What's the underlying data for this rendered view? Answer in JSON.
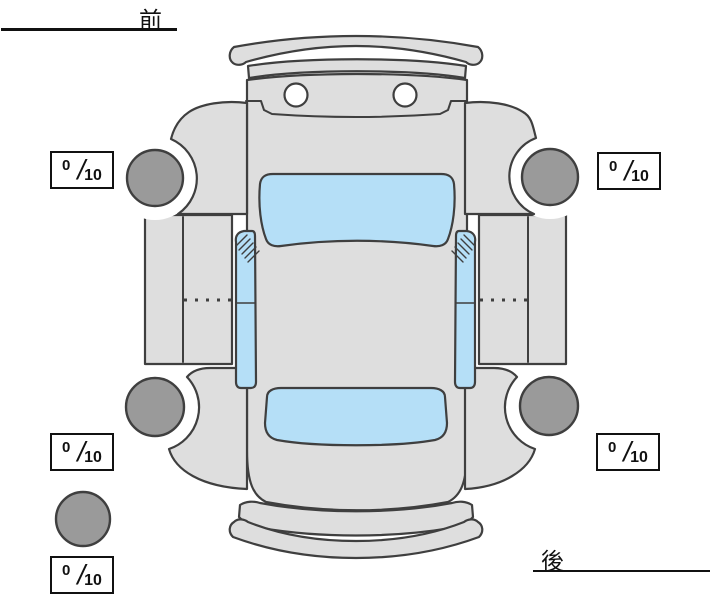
{
  "diagram": {
    "front_label": "前",
    "rear_label": "後"
  },
  "ratings": {
    "front_left": {
      "value": "0",
      "separator": "/",
      "max": "10"
    },
    "front_right": {
      "value": "0",
      "separator": "/",
      "max": "10"
    },
    "rear_left": {
      "value": "0",
      "separator": "/",
      "max": "10"
    },
    "rear_right": {
      "value": "0",
      "separator": "/",
      "max": "10"
    },
    "spare": {
      "value": "0",
      "separator": "/",
      "max": "10"
    }
  },
  "colors": {
    "page_bg": "#ffffff",
    "car_body": "#dedede",
    "car_outline": "#3f3f3f",
    "window_blue": "#b5dff7",
    "wheel_gray": "#9a9a9a",
    "headlight_white": "#ffffff",
    "ink": "#111111"
  }
}
